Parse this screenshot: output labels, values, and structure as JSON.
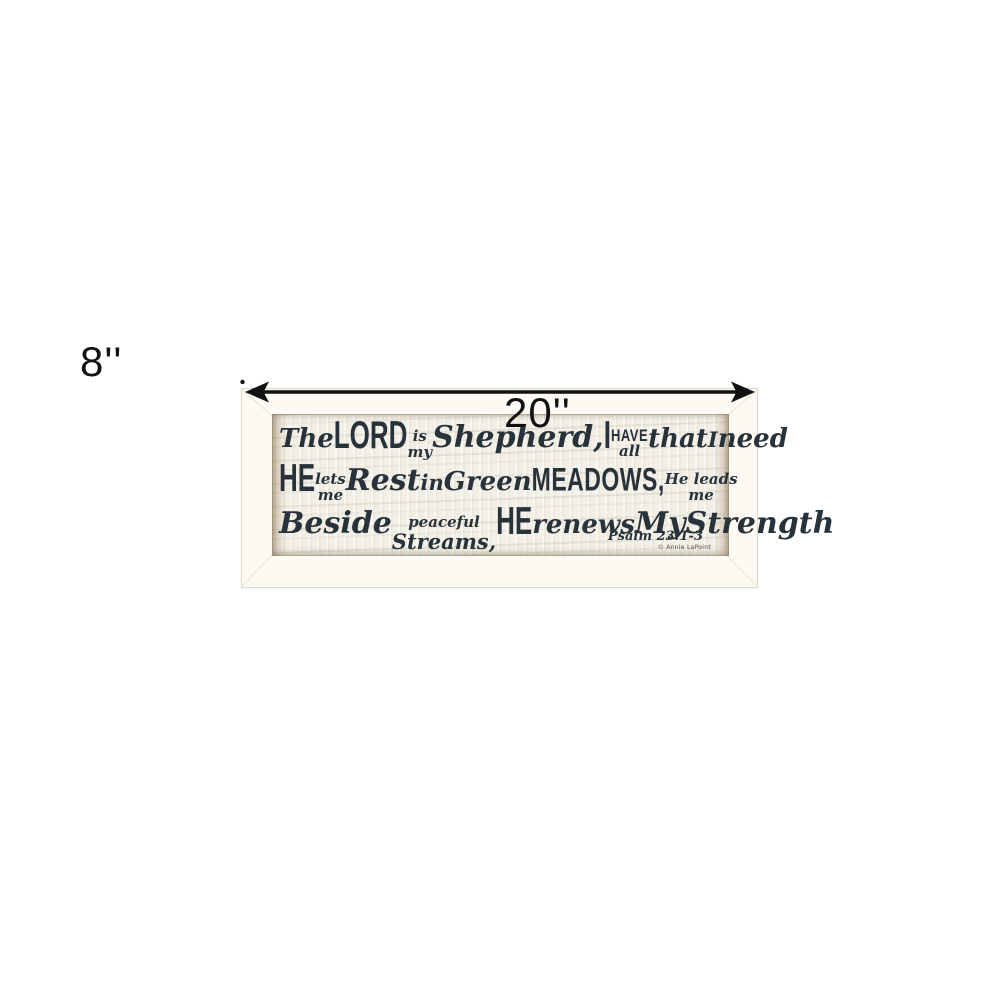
{
  "dimensions": {
    "width": "20''",
    "height": "8''"
  },
  "colors": {
    "arrow": "#111111",
    "ink": "#28323a",
    "frame_bg": "#fcfaf2",
    "frame_border": "#ddd9c8",
    "art_bg": "#f2efe6"
  },
  "artwork": {
    "reference": "Psalm 23:1-3",
    "signature": "© Annie LaPoint",
    "lines": [
      {
        "segments": [
          {
            "t": "The",
            "k": "script-lg"
          },
          {
            "t": "LORD",
            "k": "caps-xl"
          },
          {
            "stack": [
              {
                "t": "is",
                "k": "script-sm"
              },
              {
                "t": "my",
                "k": "script-sm"
              }
            ]
          },
          {
            "t": "Shepherd,",
            "k": "script-xl"
          },
          {
            "t": "I",
            "k": "caps-xl"
          },
          {
            "stack": [
              {
                "t": "HAVE",
                "k": "caps-sm"
              },
              {
                "t": "all",
                "k": "script-sm"
              }
            ]
          },
          {
            "t": "that",
            "k": "script-lg"
          },
          {
            "t": "I",
            "k": "script-md"
          },
          {
            "t": "need",
            "k": "script-lg"
          }
        ]
      },
      {
        "segments": [
          {
            "t": "HE",
            "k": "caps-xl"
          },
          {
            "stack": [
              {
                "t": "lets",
                "k": "script-sm"
              },
              {
                "t": "me",
                "k": "script-sm"
              }
            ]
          },
          {
            "t": "Rest",
            "k": "script-xl"
          },
          {
            "t": "in",
            "k": "script-md"
          },
          {
            "t": "Green",
            "k": "script-lg"
          },
          {
            "t": "MEADOWS,",
            "k": "caps-lg"
          },
          {
            "stack": [
              {
                "t": "He leads",
                "k": "script-sm"
              },
              {
                "t": "me",
                "k": "script-sm"
              }
            ]
          }
        ]
      },
      {
        "segments": [
          {
            "t": "Beside",
            "k": "script-xl"
          },
          {
            "stack": [
              {
                "t": "peaceful",
                "k": "script-sm"
              },
              {
                "t": "Streams,",
                "k": "script-md"
              }
            ]
          },
          {
            "t": "HE",
            "k": "caps-xl"
          },
          {
            "t": "renews",
            "k": "script-lg"
          },
          {
            "t": "My",
            "k": "script-xl"
          },
          {
            "t": "Strength",
            "k": "script-xl"
          }
        ]
      }
    ]
  }
}
